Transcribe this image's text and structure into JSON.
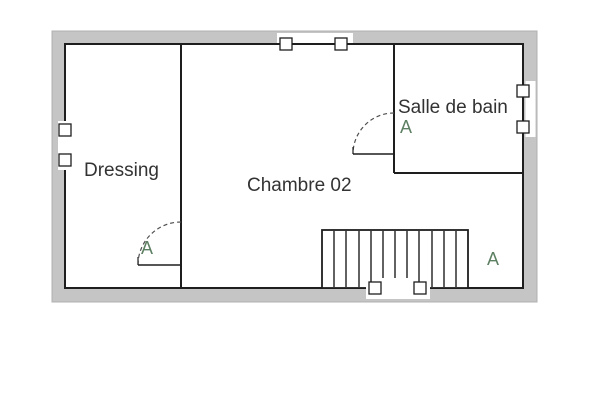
{
  "colors": {
    "wall": "#c5c5c5",
    "wall-edge": "#b0b0b0",
    "line": "#1e1e1e",
    "room-label": "#333333",
    "door-label": "#5d8063",
    "floor": "#ffffff",
    "page": "#ffffff"
  },
  "floorplan": {
    "rooms": {
      "dressing": {
        "label": "Dressing"
      },
      "chambre": {
        "label": "Chambre 02"
      },
      "salle_de_bain": {
        "label": "Salle de bain"
      }
    },
    "annotations": {
      "door_dressing": "A",
      "door_salle_de_bain": "A",
      "stairs_area": "A"
    }
  }
}
